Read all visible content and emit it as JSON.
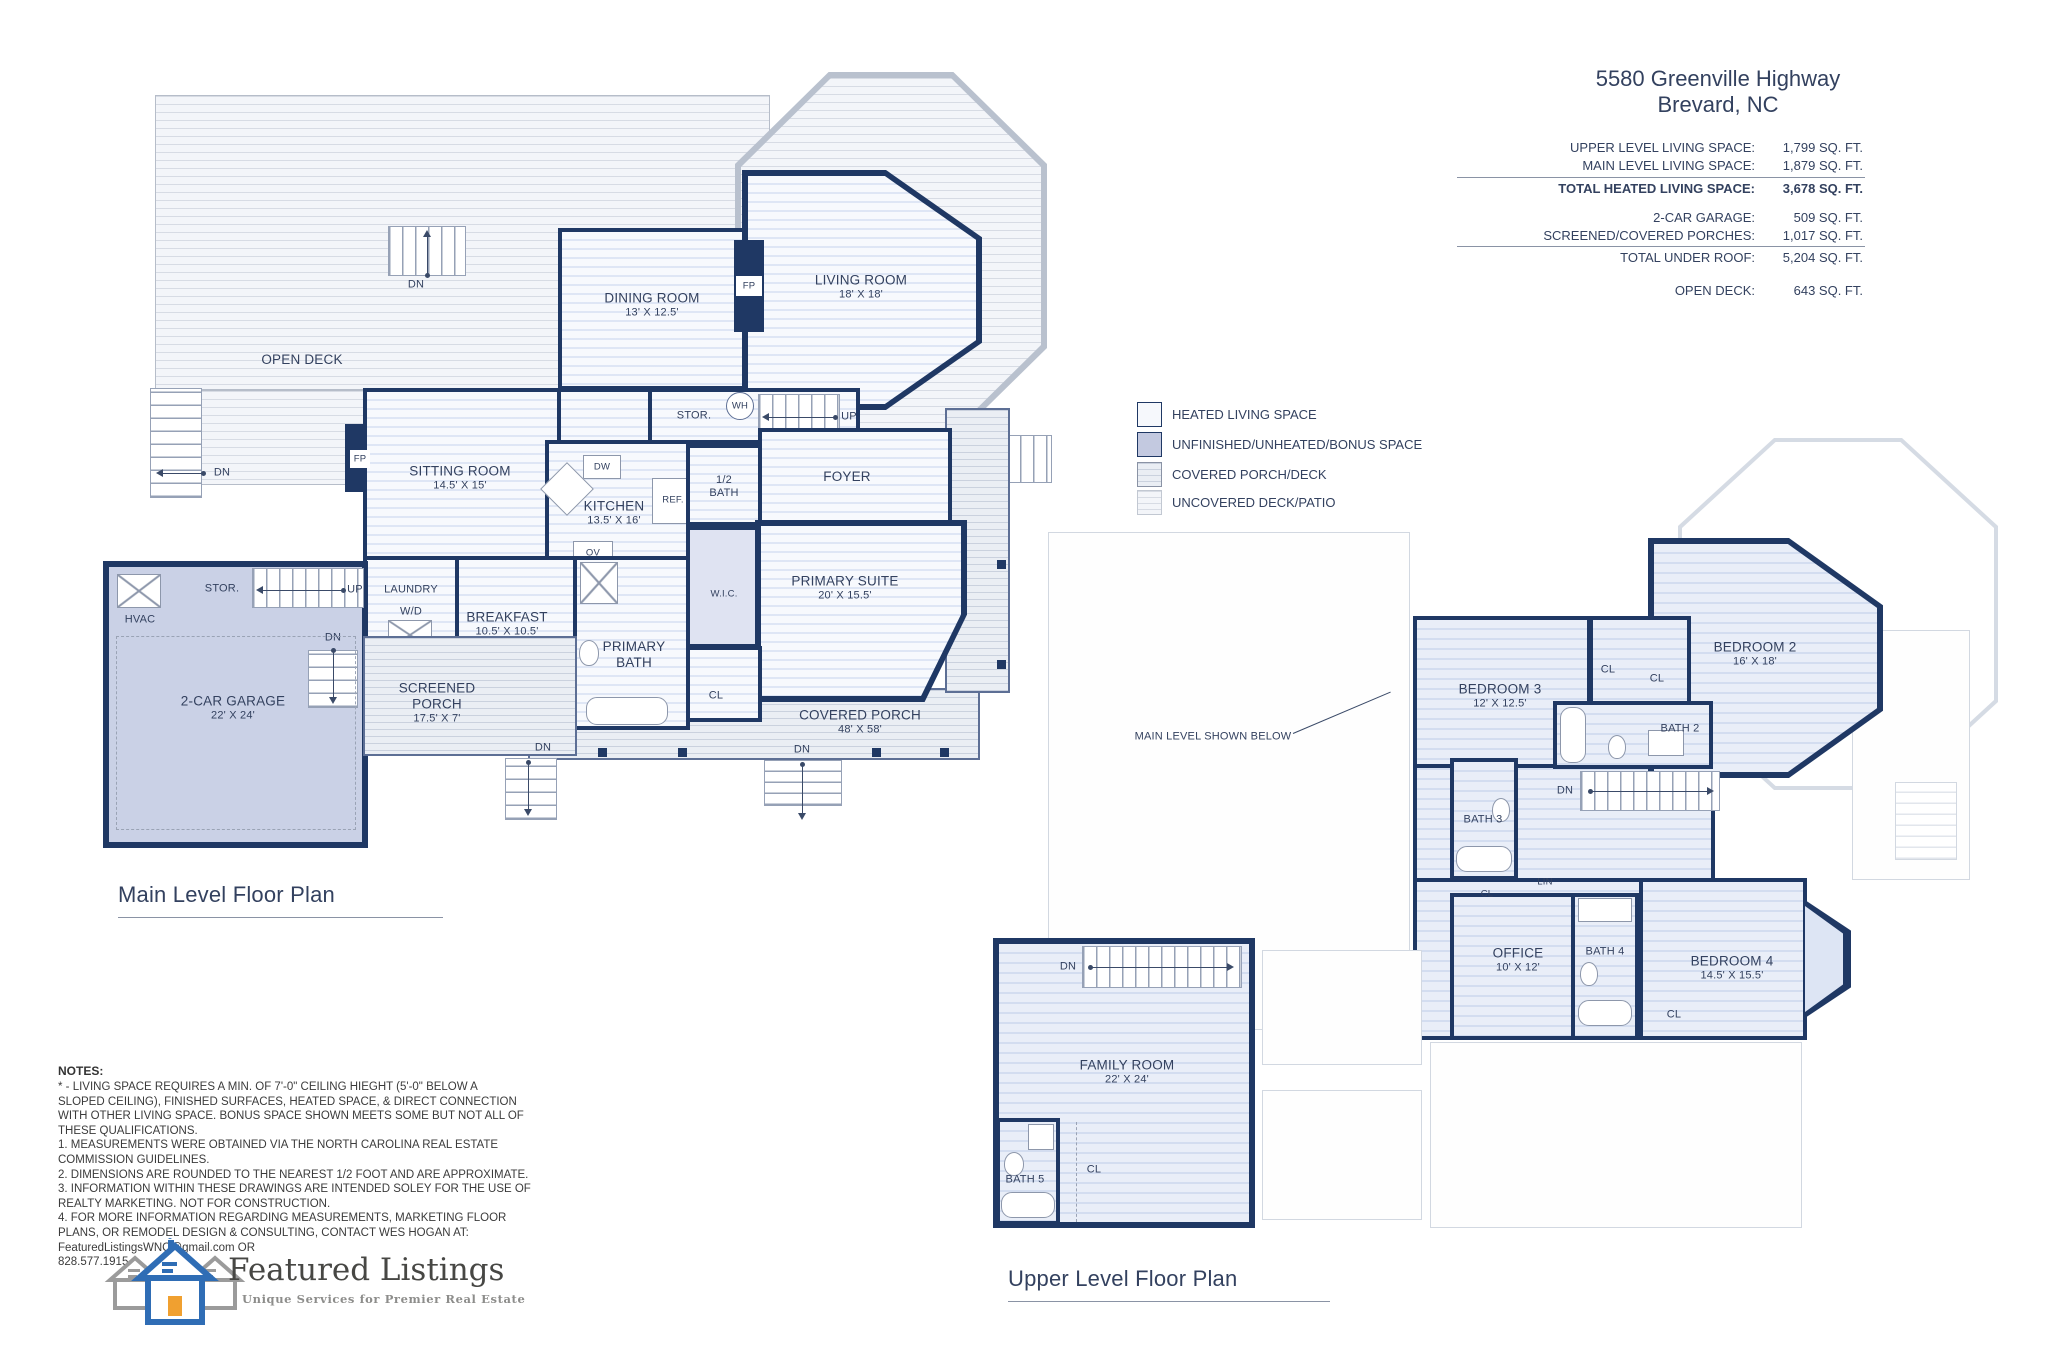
{
  "header": {
    "address_line1": "5580 Greenville Highway",
    "address_line2": "Brevard, NC",
    "rows": [
      {
        "label": "UPPER LEVEL LIVING SPACE:",
        "value": "1,799 SQ. FT."
      },
      {
        "label": "MAIN LEVEL LIVING SPACE:",
        "value": "1,879 SQ. FT."
      },
      {
        "label": "TOTAL HEATED LIVING SPACE:",
        "value": "3,678 SQ. FT."
      },
      {
        "label": "2-CAR GARAGE:",
        "value": "509 SQ. FT."
      },
      {
        "label": "SCREENED/COVERED PORCHES:",
        "value": "1,017 SQ. FT."
      },
      {
        "label": "TOTAL UNDER ROOF:",
        "value": "5,204 SQ. FT."
      },
      {
        "label": "OPEN DECK:",
        "value": "643 SQ. FT."
      }
    ]
  },
  "legend": {
    "items": [
      {
        "label": "HEATED LIVING SPACE"
      },
      {
        "label": "UNFINISHED/UNHEATED/BONUS SPACE"
      },
      {
        "label": "COVERED PORCH/DECK"
      },
      {
        "label": "UNCOVERED DECK/PATIO"
      }
    ]
  },
  "main_level": {
    "title": "Main Level Floor Plan",
    "rooms": {
      "dining": {
        "name": "DINING ROOM",
        "dims": "13' X 12.5'"
      },
      "living": {
        "name": "LIVING ROOM",
        "dims": "18' X 18'"
      },
      "sitting": {
        "name": "SITTING ROOM",
        "dims": "14.5' X 15'"
      },
      "kitchen": {
        "name": "KITCHEN",
        "dims": "13.5' X 16'"
      },
      "primary_suite": {
        "name": "PRIMARY SUITE",
        "dims": "20' X 15.5'"
      },
      "breakfast": {
        "name": "BREAKFAST",
        "dims": "10.5' X 10.5'"
      },
      "garage": {
        "name": "2-CAR GARAGE",
        "dims": "22' X 24'"
      },
      "screened_porch": {
        "name": "SCREENED PORCH",
        "dims": "17.5' X 7'"
      },
      "covered_porch": {
        "name": "COVERED PORCH",
        "dims": "48' X 58'"
      }
    },
    "labels": {
      "open_deck": "OPEN DECK",
      "stor": "STOR.",
      "wh": "WH",
      "up": "UP",
      "dn": "DN",
      "fp": "FP",
      "foyer": "FOYER",
      "half_bath": "1/2 BATH",
      "ref": "REF.",
      "dw": "DW",
      "ov": "OV",
      "wic": "W.I.C.",
      "laundry": "LAUNDRY",
      "wd": "W/D",
      "hvac": "HVAC",
      "primary_bath": "PRIMARY BATH",
      "cl": "CL"
    }
  },
  "upper_level": {
    "title": "Upper Level Floor Plan",
    "note": "MAIN LEVEL SHOWN BELOW",
    "rooms": {
      "bedroom2": {
        "name": "BEDROOM 2",
        "dims": "16' X 18'"
      },
      "bedroom3": {
        "name": "BEDROOM 3",
        "dims": "12' X 12.5'"
      },
      "office": {
        "name": "OFFICE",
        "dims": "10' X 12'"
      },
      "bedroom4": {
        "name": "BEDROOM 4",
        "dims": "14.5' X 15.5'"
      }
    },
    "labels": {
      "bath2": "BATH 2",
      "bath3": "BATH 3",
      "bath4": "BATH 4",
      "lin": "LIN",
      "cl": "CL",
      "dn": "DN"
    }
  },
  "bonus_level": {
    "rooms": {
      "family": {
        "name": "FAMILY ROOM",
        "dims": "22' X 24'"
      }
    },
    "labels": {
      "bath5": "BATH 5",
      "cl": "CL",
      "dn": "DN"
    }
  },
  "notes": {
    "title": "NOTES:",
    "body": "* - LIVING SPACE REQUIRES A MIN. OF 7'-0\" CEILING HIEGHT (5'-0\" BELOW A\nSLOPED CEILING), FINISHED SURFACES, HEATED SPACE, & DIRECT CONNECTION\nWITH OTHER LIVING SPACE. BONUS SPACE SHOWN MEETS SOME BUT NOT ALL OF\nTHESE QUALIFICATIONS.\n1. MEASUREMENTS WERE OBTAINED VIA THE NORTH CAROLINA REAL ESTATE\nCOMMISSION GUIDELINES.\n2. DIMENSIONS ARE ROUNDED TO THE NEAREST 1/2 FOOT AND ARE APPROXIMATE.\n3. INFORMATION WITHIN THESE DRAWINGS ARE INTENDED SOLEY FOR THE USE OF\nREALTY MARKETING.  NOT FOR CONSTRUCTION.\n4. FOR MORE INFORMATION REGARDING MEASUREMENTS, MARKETING FLOOR\nPLANS, OR REMODEL DESIGN & CONSULTING, CONTACT WES HOGAN AT:\nFeaturedListingsWNC@gmail.com    OR\n828.577.1915"
  },
  "logo": {
    "name": "Featured Listings",
    "tagline": "Unique Services for Premier Real Estate"
  }
}
